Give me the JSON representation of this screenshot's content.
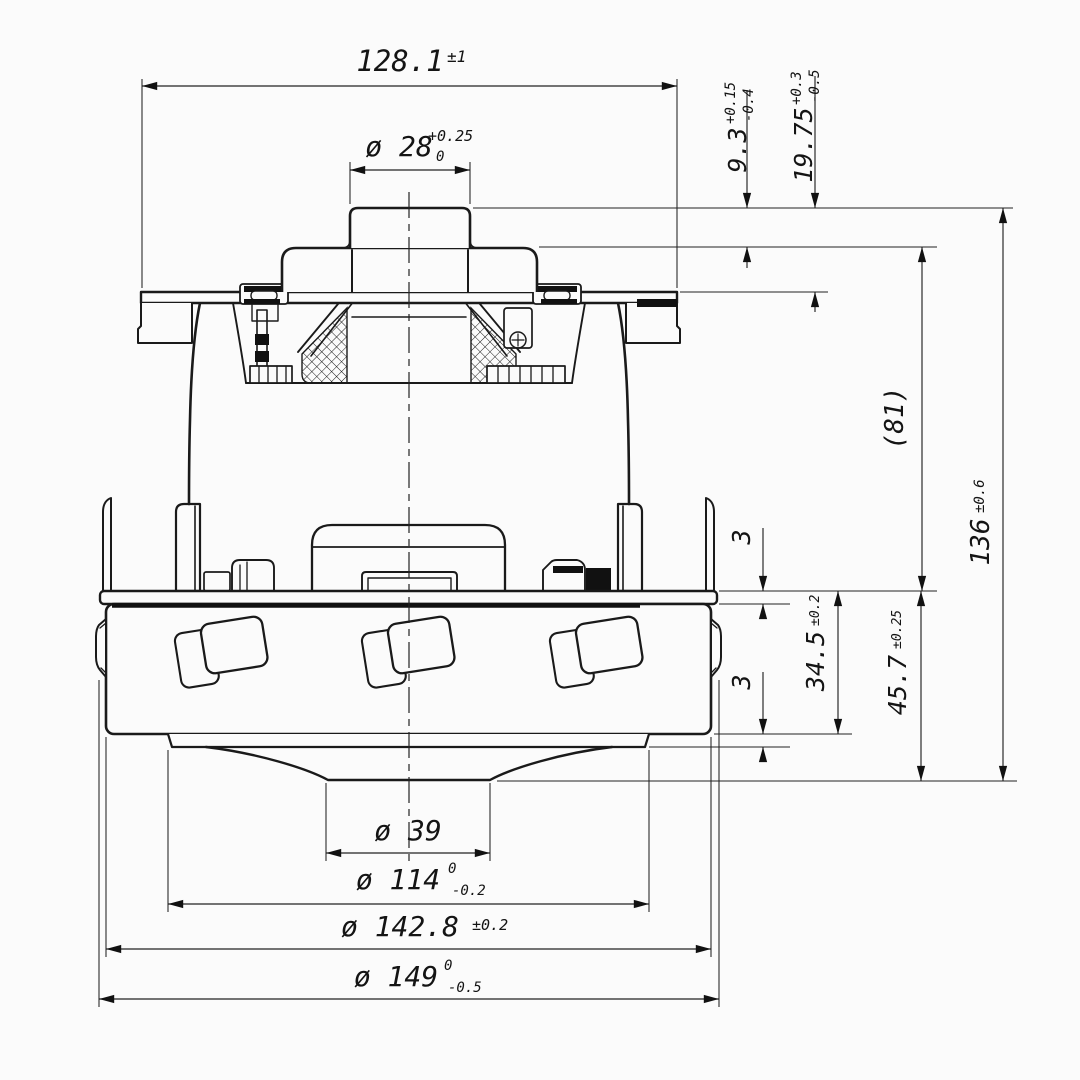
{
  "page": {
    "background": "#fbfbfb",
    "line_color": "#1a1a1a",
    "description": "orthographic dimensioned drawing of a vacuum cleaner suction motor, front section view"
  },
  "dims": {
    "width_flange": {
      "label": "128.1",
      "tol": "±1"
    },
    "bore": {
      "label": "ø 28",
      "tol_upper": "+0.25",
      "tol_lower": "0"
    },
    "boss_height": {
      "label": "9.3",
      "tol_upper": "+0.15",
      "tol_lower": "-0.4"
    },
    "neck_height": {
      "label": "19.75",
      "tol_upper": "+0.3",
      "tol_lower": "-0.5"
    },
    "body_height_ref": {
      "label": "(81)"
    },
    "overall_height": {
      "label": "136",
      "tol": "±0.6"
    },
    "plate_thickness": {
      "label": "3"
    },
    "drum_height": {
      "label": "34.5",
      "tol": "±0.2"
    },
    "lip_thickness": {
      "label": "3"
    },
    "lower_section_height": {
      "label": "45.7",
      "tol": "±0.25"
    },
    "dia_hub": {
      "label": "ø 39"
    },
    "dia_ring": {
      "label": "ø 114",
      "tol_upper": "0",
      "tol_lower": "-0.2"
    },
    "dia_drum": {
      "label": "ø 142.8",
      "tol": "±0.2"
    },
    "dia_outer": {
      "label": "ø 149",
      "tol_upper": "0",
      "tol_lower": "-0.5"
    }
  }
}
